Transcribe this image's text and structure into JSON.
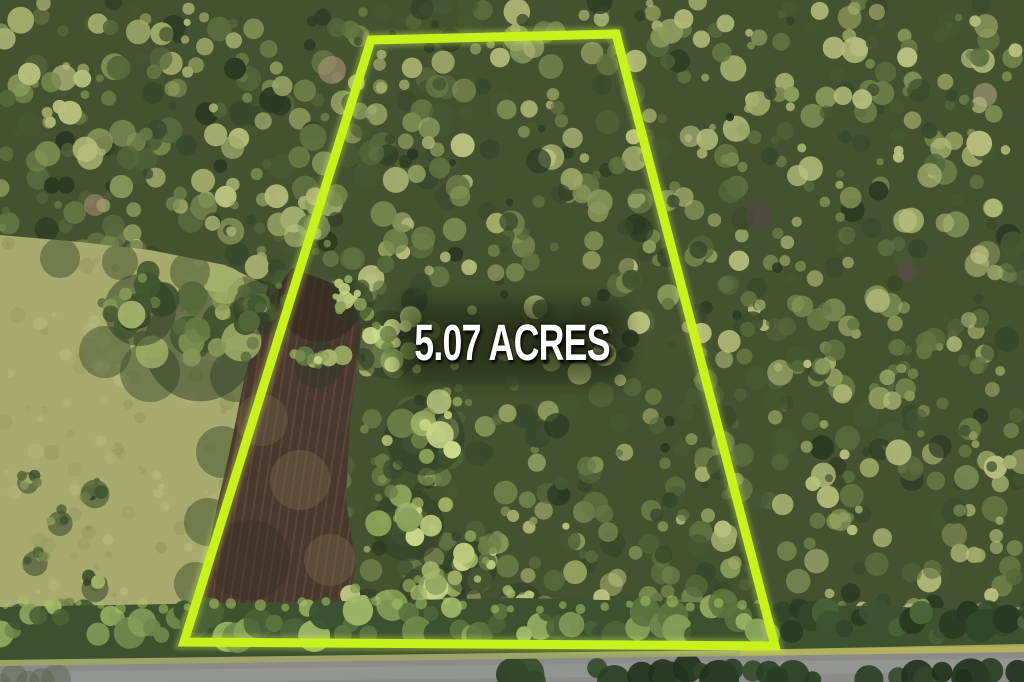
{
  "overlay": {
    "acreage_text": "5.07 ACRES",
    "text_color": "#ffffff",
    "boundary_color": "#c9f21d",
    "boundary_glow_color": "#dcfc52",
    "boundary_stroke_width": 9,
    "boundary_points": [
      [
        371,
        40
      ],
      [
        616,
        34
      ],
      [
        775,
        646
      ],
      [
        184,
        642
      ]
    ],
    "label_center": [
      512,
      342
    ]
  },
  "scene": {
    "seed": 20,
    "base_color": "#45522f",
    "canopy_count": 1500,
    "canopy_palette": [
      "#2b3922",
      "#38482b",
      "#475833",
      "#56683c",
      "#667845",
      "#78894f",
      "#8c9a5c",
      "#a2ad6b",
      "#b8c07e"
    ],
    "tree_palette": [
      "#2f4026",
      "#41552f",
      "#57693a",
      "#6d8047",
      "#859757",
      "#a2b168"
    ],
    "sunlit_palette": [
      "#6d8047",
      "#8aa058",
      "#a5b86a",
      "#bccc7d",
      "#ccd98c"
    ],
    "field": {
      "points": [
        [
          0,
          235
        ],
        [
          80,
          242
        ],
        [
          150,
          250
        ],
        [
          225,
          265
        ],
        [
          268,
          286
        ],
        [
          252,
          356
        ],
        [
          232,
          440
        ],
        [
          214,
          520
        ],
        [
          200,
          590
        ],
        [
          190,
          642
        ],
        [
          0,
          645
        ]
      ],
      "fill": "#a7ab6e",
      "speckle_light": "#c0c388",
      "speckle_dark": "#8b9157",
      "speckle_count": 150,
      "shadow_color": "#3d4d2c",
      "shadows": [
        [
          250,
          300,
          24
        ],
        [
          236,
          376,
          26
        ],
        [
          222,
          452,
          26
        ],
        [
          208,
          522,
          24
        ],
        [
          196,
          584,
          22
        ],
        [
          150,
          372,
          30
        ],
        [
          105,
          352,
          26
        ],
        [
          60,
          258,
          20
        ],
        [
          120,
          262,
          18
        ],
        [
          190,
          272,
          20
        ]
      ]
    },
    "field_trees": [
      [
        200,
        330,
        62
      ],
      [
        140,
        300,
        40
      ],
      [
        260,
        300,
        30
      ],
      [
        95,
        490,
        16
      ],
      [
        60,
        520,
        14
      ],
      [
        35,
        560,
        14
      ],
      [
        95,
        585,
        15
      ],
      [
        60,
        610,
        16
      ],
      [
        130,
        620,
        14
      ],
      [
        28,
        480,
        12
      ]
    ],
    "parcel_trees": [
      [
        388,
        335,
        38
      ],
      [
        425,
        425,
        44
      ],
      [
        408,
        515,
        40
      ],
      [
        432,
        588,
        38
      ],
      [
        368,
        607,
        28
      ],
      [
        352,
        296,
        24
      ],
      [
        318,
        358,
        26
      ],
      [
        470,
        560,
        30
      ],
      [
        520,
        600,
        26
      ]
    ],
    "dirt": {
      "points": [
        [
          292,
          268
        ],
        [
          350,
          290
        ],
        [
          362,
          330
        ],
        [
          350,
          420
        ],
        [
          346,
          500
        ],
        [
          356,
          565
        ],
        [
          342,
          628
        ],
        [
          196,
          634
        ],
        [
          208,
          560
        ],
        [
          226,
          470
        ],
        [
          244,
          380
        ],
        [
          262,
          310
        ]
      ],
      "fill": "#4a382f",
      "striation": "#7c684a",
      "patches": [
        [
          320,
          300,
          42,
          "#2e261e",
          0.55
        ],
        [
          300,
          480,
          30,
          "#8d7a58",
          0.3
        ],
        [
          330,
          560,
          26,
          "#8d7a58",
          0.3
        ],
        [
          262,
          420,
          26,
          "#8d7a58",
          0.25
        ],
        [
          250,
          560,
          40,
          "#3a2f26",
          0.4
        ]
      ]
    },
    "hedge": {
      "points": [
        [
          0,
          607
        ],
        [
          520,
          598
        ],
        [
          1024,
          610
        ],
        [
          1024,
          652
        ],
        [
          0,
          662
        ]
      ],
      "fill": "#3e512e",
      "palette": [
        "#3c5130",
        "#4c6338",
        "#5d7440",
        "#6f874b",
        "#87a05a",
        "#9fb768"
      ],
      "dark_palette": [
        "#273a22",
        "#31472a",
        "#3c5331",
        "#4a6339"
      ],
      "highlight": "#a9c266"
    },
    "verge": {
      "points": [
        [
          0,
          660
        ],
        [
          1024,
          646
        ],
        [
          1024,
          658
        ],
        [
          0,
          672
        ]
      ],
      "fill": "#9ea468",
      "sunlit_points": [
        [
          740,
          650
        ],
        [
          1024,
          644
        ],
        [
          1024,
          658
        ],
        [
          740,
          664
        ]
      ],
      "sunlit_fill": "#b5b55e"
    },
    "road": {
      "points": [
        [
          0,
          666
        ],
        [
          1024,
          652
        ],
        [
          1024,
          682
        ],
        [
          0,
          682
        ]
      ],
      "fill": "#8b8c8a",
      "light": "#9a9b98",
      "stripe_points": [
        [
          0,
          672
        ],
        [
          1024,
          658
        ],
        [
          1024,
          672
        ],
        [
          0,
          684
        ]
      ],
      "overhang_palette": [
        "#20301c",
        "#2a3d23",
        "#35482a"
      ]
    },
    "accents": [
      {
        "x": 332,
        "y": 70,
        "r": 14,
        "color": "#b49a82"
      },
      {
        "x": 95,
        "y": 205,
        "r": 11,
        "color": "#ad9179"
      },
      {
        "x": 758,
        "y": 215,
        "r": 13,
        "color": "#59454e"
      },
      {
        "x": 908,
        "y": 272,
        "r": 10,
        "color": "#5e4a50"
      },
      {
        "x": 985,
        "y": 95,
        "r": 12,
        "color": "#b7a98c"
      }
    ]
  }
}
